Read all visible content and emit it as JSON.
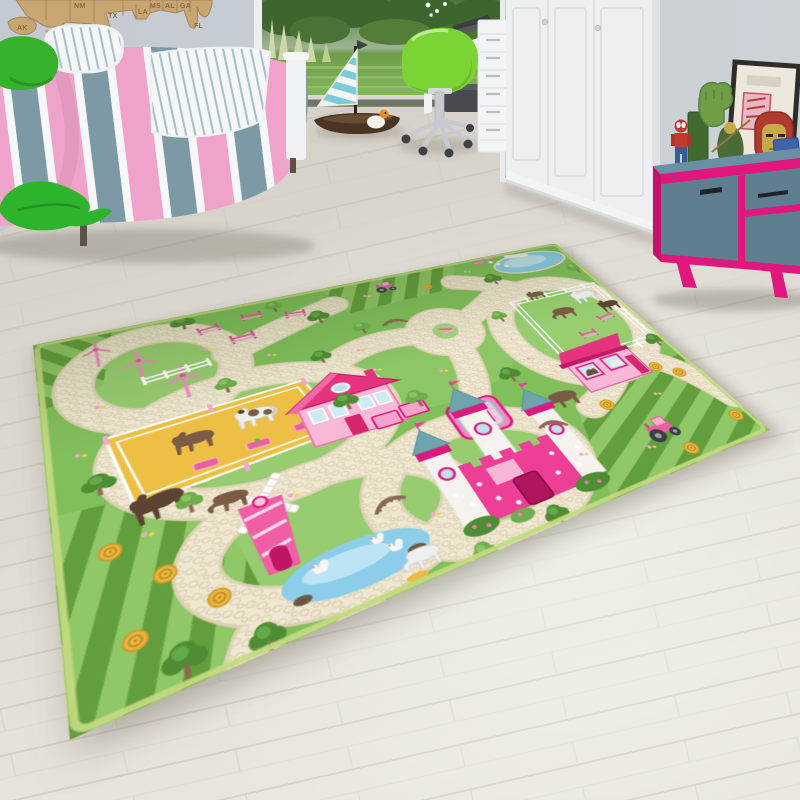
{
  "scene": {
    "type": "photograph",
    "setting": "kids bedroom with a green farm-and-castle play rug on a light wood floor"
  },
  "palette": {
    "wall": "#c9cfd5",
    "floor": "#d9d5cd",
    "floorLight": "#e9e5dd",
    "plankLine": "#c6c0b5",
    "mapWood": "#c8a671",
    "bedBlue": "#7d99a6",
    "bedPink": "#efa3ca",
    "greenPillow": "#35b12c",
    "chairGreen": "#7cd336",
    "wardrobeWhite": "#edeff0",
    "sideboardTeal": "#5d7f90",
    "sideboardPink": "#e0187e",
    "rugGreen": "#81bf5b",
    "rugLightGreen": "#a4d47c",
    "roadCream": "#efe7d2",
    "stripeDark": "#639e3d",
    "stripeLight": "#90c767",
    "pondBlue": "#8ccdea",
    "paddockYellow": "#edbf45",
    "pinkHouse": "#f9b9d6",
    "pinkRoof": "#e5337e",
    "hayYellow": "#ecba3e",
    "horseBrown": "#7b5b44",
    "treeGreen": "#4e8d33",
    "trunkBrown": "#8a6a4f"
  },
  "map": {
    "name": "wooden-usa-map",
    "labels": [
      "AK",
      "NM",
      "TX",
      "LA",
      "MS",
      "AL",
      "GA",
      "FL"
    ]
  },
  "room": {
    "objects": [
      "striped bed",
      "green leaf cushion",
      "wooden US map",
      "garden doorway",
      "toy sailboat",
      "duck toy",
      "green shell swivel chair",
      "white desk",
      "white drawer unit",
      "white wardrobe",
      "teal sideboard with pink trim",
      "picture frame",
      "hulk fist",
      "lego spiderman",
      "iron man helmet",
      "green action figure",
      "shield box"
    ]
  },
  "rug": {
    "name": "green farm and castle play rug",
    "features": [
      "winding cream pebble roads",
      "pink castle with crown plaque",
      "pink farmhouse",
      "pink horse stable",
      "pink windmill",
      "pink wind turbines",
      "horse paddocks with white fences",
      "show jumps",
      "pond with dock",
      "swan pond",
      "pink tractors",
      "hay bales",
      "striped crop fields",
      "wooden bridges",
      "trees and flowers"
    ]
  }
}
